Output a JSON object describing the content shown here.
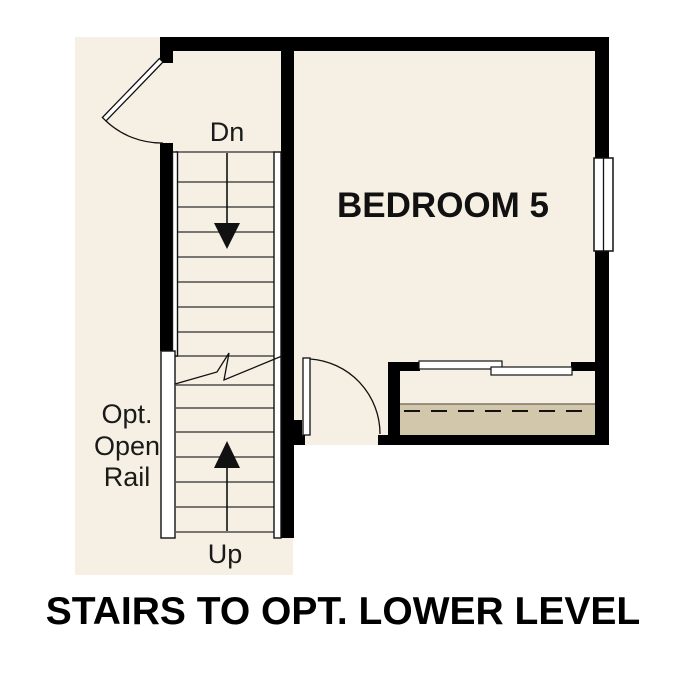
{
  "plan": {
    "room": {
      "label": "BEDROOM 5"
    },
    "stairs": {
      "down_label": "Dn",
      "up_label": "Up",
      "open_rail_note": [
        "Opt.",
        "Open",
        "Rail"
      ]
    },
    "caption": "STAIRS TO OPT. LOWER LEVEL"
  },
  "colors": {
    "background": "#ffffff",
    "floor": "#f6f0e4",
    "shelf": "#d2c6ab",
    "wall": "#000000",
    "tread": "#4d4d4d"
  }
}
